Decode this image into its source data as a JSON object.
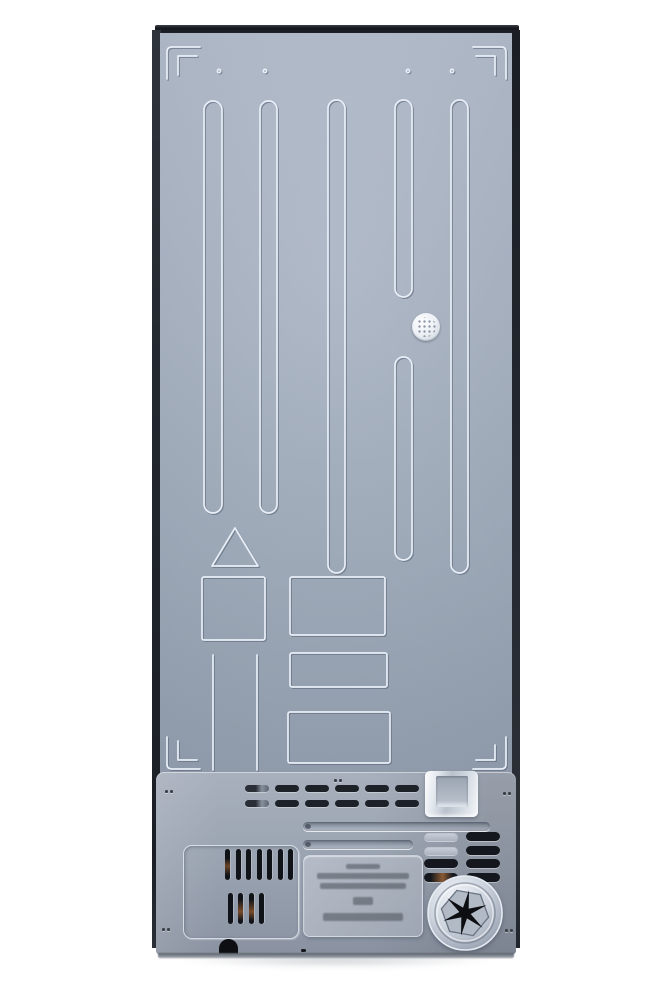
{
  "image": {
    "kind": "product-photo",
    "subject": "refrigerator rear panel",
    "background_color": "#ffffff"
  },
  "colors": {
    "top_cap": "#1a1e24",
    "side_trim": "#23272e",
    "back_panel": "#a3adbd",
    "compressor_cover": "#99a2b0",
    "stamp_highlight": "#e9eff8",
    "stamp_shadow": "#5c687a",
    "vent_slot": "#1d2128",
    "copper_tube_glimpse": "#7a4b2a",
    "bracket_metal": "#e3e8ee",
    "drain_star": "#0c0e12"
  },
  "back_panel": {
    "ribs_count": 5,
    "alignment_dots": 4,
    "corner_brackets": 4,
    "stamped_shapes": [
      "triangle",
      "square",
      "rectangle",
      "rectangle",
      "rectangle",
      "column-lines"
    ],
    "vent_plug": {
      "shape": "perforated-circle"
    }
  },
  "compressor_cover": {
    "top_vent_row": {
      "groups": 6,
      "slots_per_group": 2
    },
    "grooves": 2,
    "screws": 5,
    "left_grille": {
      "row_slot_counts": [
        7,
        4
      ]
    },
    "right_vent_grid": {
      "rows": 4,
      "cols": 2,
      "cells": [
        [
          "closed",
          "open"
        ],
        [
          "closed",
          "open"
        ],
        [
          "open",
          "open"
        ],
        [
          "copper",
          "open"
        ]
      ]
    },
    "rating_plate": {
      "text_legible": false,
      "line_widths_px": [
        34,
        92,
        86,
        20,
        80
      ],
      "line_heights_px": [
        5,
        6,
        6,
        8,
        8
      ],
      "line_tops_px": [
        8,
        17,
        27,
        41,
        57
      ]
    },
    "drain_cap": {
      "style": "hexagon-with-six-point-star"
    },
    "drain_hole": 1
  }
}
